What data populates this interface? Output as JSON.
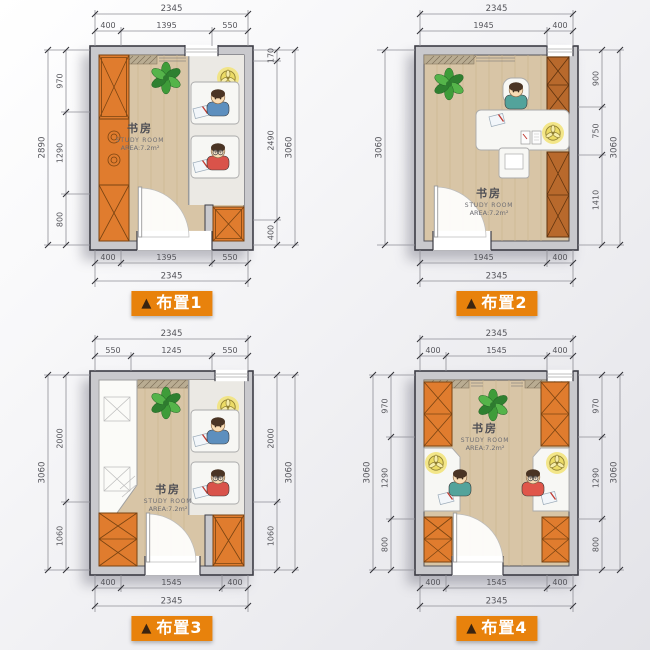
{
  "room": {
    "cn": "书房",
    "en": "STUDY ROOM",
    "area": "AREA:7.2m²"
  },
  "marker": "▲",
  "plans": [
    {
      "label": "布置1",
      "top_total": "2345",
      "top_segs": [
        "400",
        "1395",
        "550"
      ],
      "bottom_total": "2345",
      "bottom_segs": [
        "400",
        "1395",
        "550"
      ],
      "left_total": "2890",
      "left_segs": [
        "970",
        "1290",
        "800"
      ],
      "right_total": "3060",
      "right_segs": [
        "170",
        "2490",
        "400"
      ]
    },
    {
      "label": "布置2",
      "top_total": "2345",
      "top_segs": [
        "1945",
        "400"
      ],
      "bottom_total": "2345",
      "bottom_segs": [
        "1945",
        "400"
      ],
      "left_total": "3060",
      "left_segs": [],
      "right_total": "3060",
      "right_segs": [
        "900",
        "750",
        "1410"
      ]
    },
    {
      "label": "布置3",
      "top_total": "2345",
      "top_segs": [
        "550",
        "1245",
        "550"
      ],
      "bottom_total": "2345",
      "bottom_segs": [
        "400",
        "1545",
        "400"
      ],
      "left_total": "3060",
      "left_segs": [
        "2000",
        "1060"
      ],
      "right_total": "3060",
      "right_segs": [
        "2000",
        "1060"
      ]
    },
    {
      "label": "布置4",
      "top_total": "2345",
      "top_segs": [
        "400",
        "1545",
        "400"
      ],
      "bottom_total": "2345",
      "bottom_segs": [
        "400",
        "1545",
        "400"
      ],
      "left_total": "3060",
      "left_segs": [
        "970",
        "1290",
        "800"
      ],
      "right_total": "3060",
      "right_segs": [
        "970",
        "1290",
        "800"
      ]
    }
  ],
  "colors": {
    "accent": "#e8820c",
    "furniture_orange": "#e07c2e",
    "furniture_brown": "#b8692c",
    "wall": "#c9c9cd",
    "floor_wood": "#d8c5a6",
    "lamp": "#f2e37c",
    "plant": "#3e9c39"
  }
}
